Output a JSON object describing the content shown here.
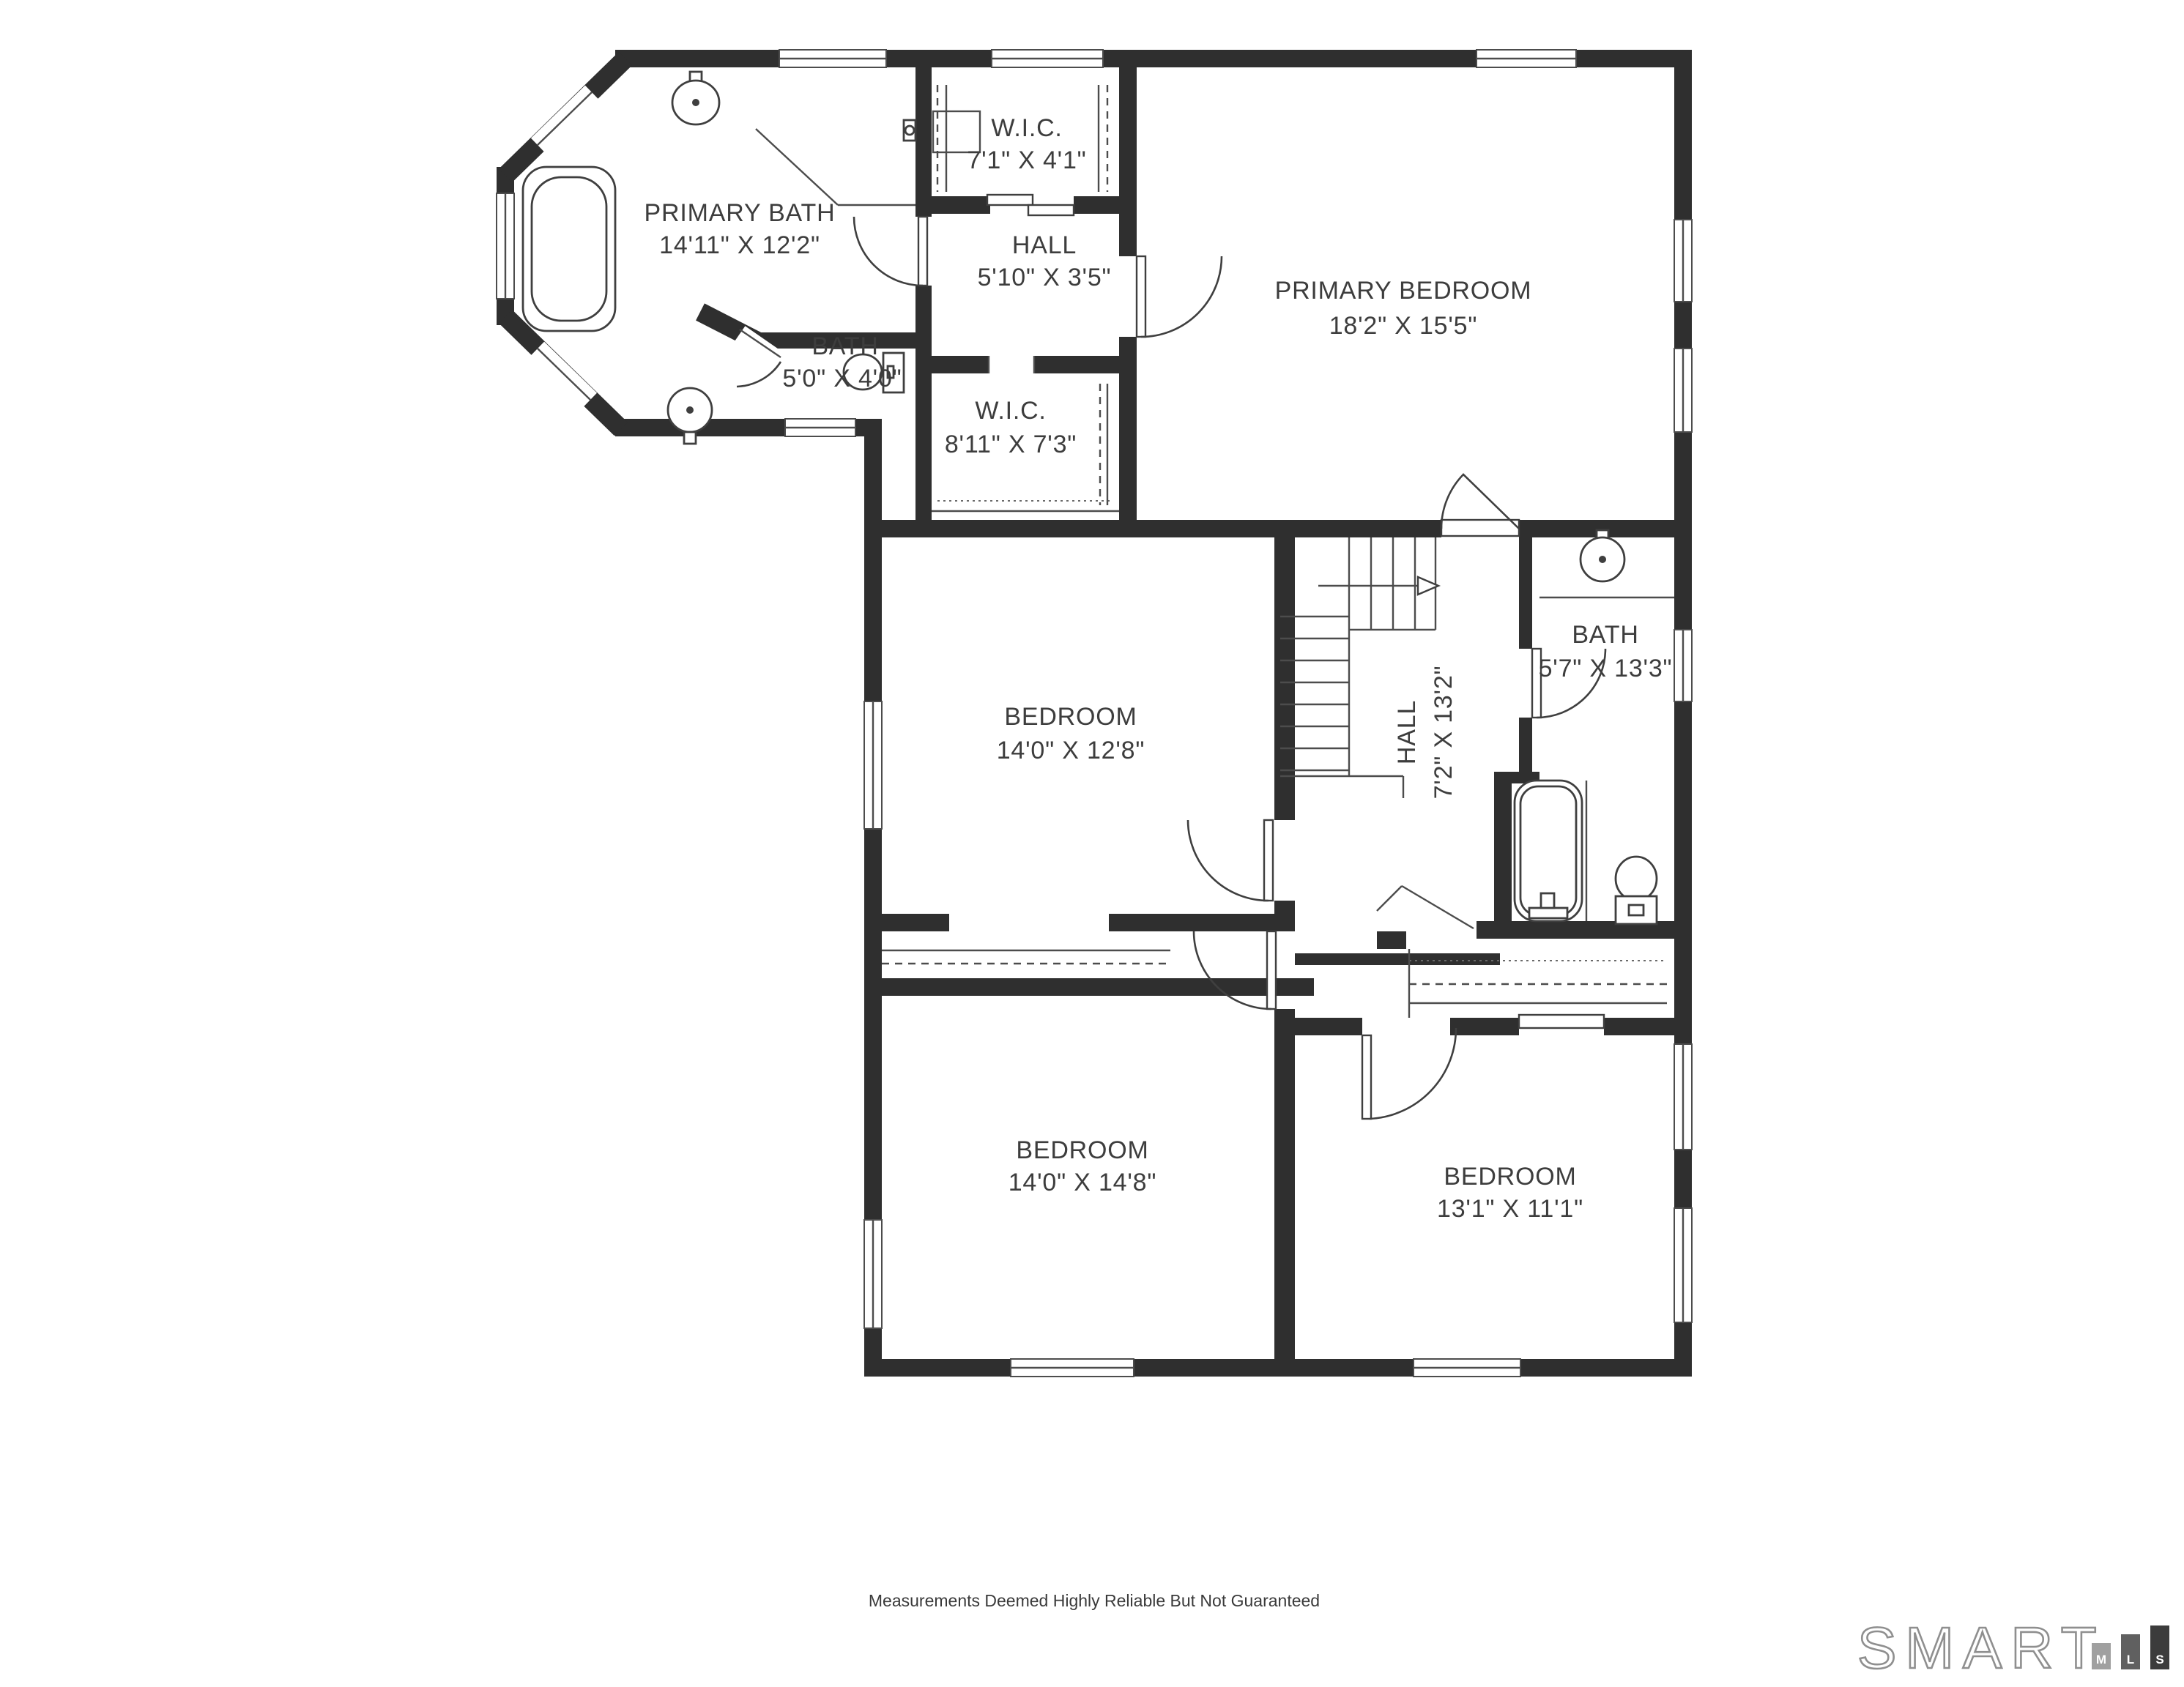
{
  "rooms": [
    {
      "id": "primary-bath",
      "name": "PRIMARY BATH",
      "dims": "14'11\" X 12'2\""
    },
    {
      "id": "wic-upper",
      "name": "W.I.C.",
      "dims": "7'1\" X 4'1\""
    },
    {
      "id": "hall-upper",
      "name": "HALL",
      "dims": "5'10\" X 3'5\""
    },
    {
      "id": "primary-bedroom",
      "name": "PRIMARY BEDROOM",
      "dims": "18'2\" X 15'5\""
    },
    {
      "id": "bath-small",
      "name": "BATH",
      "dims": "5'0\" X 4'0\""
    },
    {
      "id": "wic-lower",
      "name": "W.I.C.",
      "dims": "8'11\" X 7'3\""
    },
    {
      "id": "bedroom-middle",
      "name": "BEDROOM",
      "dims": "14'0\" X 12'8\""
    },
    {
      "id": "hall-stairs",
      "name": "HALL",
      "dims": "7'2\" X 13'2\""
    },
    {
      "id": "bath-main",
      "name": "BATH",
      "dims": "5'7\" X 13'3\""
    },
    {
      "id": "bedroom-bottom-left",
      "name": "BEDROOM",
      "dims": "14'0\" X 14'8\""
    },
    {
      "id": "bedroom-bottom-right",
      "name": "BEDROOM",
      "dims": "13'1\" X 11'1\""
    }
  ],
  "footer": {
    "disclaimer": "Measurements Deemed Highly Reliable But Not Guaranteed"
  },
  "logo": {
    "brand": "SMART",
    "bars": [
      "M",
      "L",
      "S"
    ]
  },
  "colors": {
    "wall": "#2f2f2f",
    "line": "#4c4c4c",
    "text": "#3d3d3d",
    "background": "#ffffff",
    "logo_bar_m": "#a0a0a0",
    "logo_bar_l": "#606060",
    "logo_bar_s": "#3c3c3c",
    "logo_outline": "#8f8f8f"
  }
}
